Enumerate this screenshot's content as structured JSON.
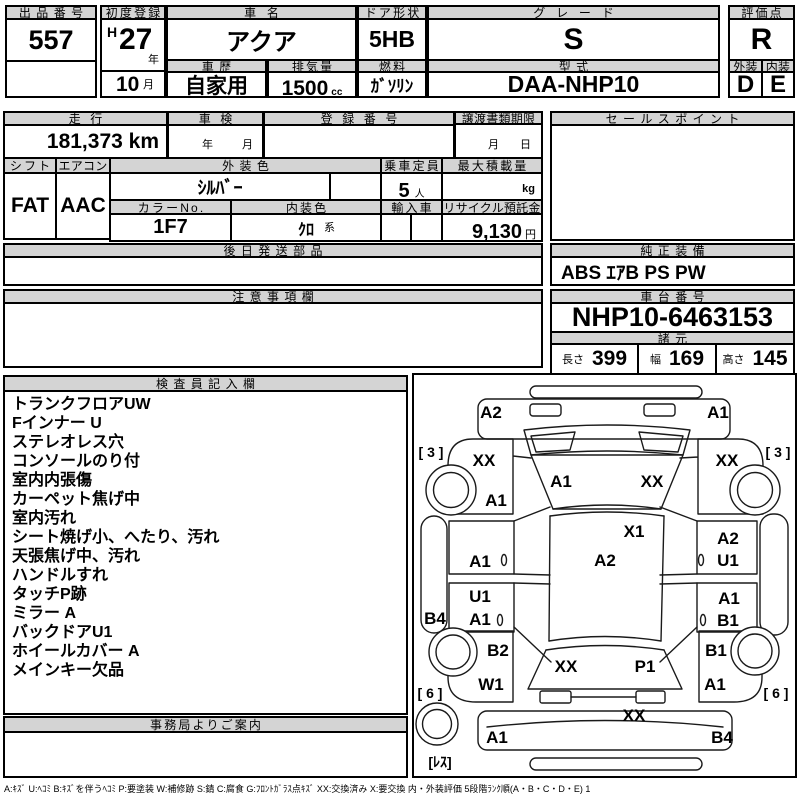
{
  "header": {
    "lot_label": "出品番号",
    "lot_number": "557",
    "first_reg_label": "初度登録",
    "era": "H",
    "reg_year": "27",
    "year_suffix": "年",
    "reg_month": "10",
    "month_suffix": "月",
    "car_name_label": "車名",
    "car_name": "アクア",
    "door_label": "ドア形状",
    "door": "5HB",
    "grade_label": "グレード",
    "grade": "S",
    "score_label": "評価点",
    "score": "R",
    "history_label": "車歴",
    "history": "自家用",
    "displacement_label": "排気量",
    "displacement": "1500",
    "displacement_unit": "cc",
    "fuel_label": "燃料",
    "fuel": "ｶﾞｿﾘﾝ",
    "model_label": "型式",
    "model_code": "DAA-NHP10",
    "exterior_label": "外装",
    "exterior_grade": "D",
    "interior_label": "内装",
    "interior_grade": "E"
  },
  "info": {
    "mileage_label": "走行",
    "mileage": "181,373 km",
    "inspection_label": "車検",
    "inspection_year": "年",
    "inspection_month": "月",
    "registration_label": "登録番号",
    "transfer_label": "譲渡書類期限",
    "transfer_month": "月",
    "transfer_day": "日",
    "shift_label": "シフト",
    "shift": "FAT",
    "aircon_label": "エアコン",
    "aircon": "AAC",
    "ext_color_label": "外装色",
    "ext_color": "ｼﾙﾊﾞｰ",
    "capacity_label": "乗車定員",
    "capacity": "5",
    "capacity_unit": "人",
    "max_load_label": "最大積載量",
    "max_load_unit": "kg",
    "color_no_label": "カラーNo.",
    "color_no": "1F7",
    "int_color_label": "内装色",
    "int_color": "ｸﾛ",
    "int_color_suffix": "系",
    "import_label": "輸入車",
    "recycle_label": "リサイクル預託金",
    "recycle_fee": "9,130",
    "recycle_unit": "円"
  },
  "sales_point": {
    "label": "セールスポイント"
  },
  "later_parts": {
    "label": "後日発送部品"
  },
  "notes": {
    "label": "注意事項欄"
  },
  "equipment": {
    "label": "純正装備",
    "value": "ABS ｴｱB PS PW"
  },
  "chassis": {
    "label": "車台番号",
    "number": "NHP10-6463153"
  },
  "dimensions": {
    "label": "諸元",
    "length_label": "長さ",
    "length": "399",
    "width_label": "幅",
    "width": "169",
    "height_label": "高さ",
    "height": "145"
  },
  "inspector": {
    "label": "検査員記入欄",
    "items": [
      "トランクフロアUW",
      "Fインナー U",
      "ステレオレス穴",
      "コンソールのり付",
      "室内内張傷",
      "カーペット焦げ中",
      "室内汚れ",
      "シート焼げ小、へたり、汚れ",
      "天張焦げ中、汚れ",
      "ハンドルすれ",
      "タッチP跡",
      "ミラー A",
      "バックドアU1",
      "ホイールカバー A",
      "メインキー欠品"
    ]
  },
  "office": {
    "label": "事務局よりご案内"
  },
  "diagram": {
    "marks": [
      "A2",
      "A1",
      "[ 3 ]",
      "XX",
      "XX",
      "[ 3 ]",
      "A1",
      "XX",
      "A1",
      "X1",
      "A2",
      "A2",
      "A1",
      "U1",
      "U1",
      "A1",
      "B4",
      "A1",
      "B1",
      "B2",
      "B1",
      "XX",
      "P1",
      "W1",
      "A1",
      "[ 6 ]",
      "[ 6 ]",
      "XX",
      "A1",
      "B4",
      "[ﾚｽ]"
    ]
  },
  "legend": "A:ｷｽﾞ U:ﾍｺﾐ B:ｷｽﾞを伴うﾍｺﾐ P:要塗装 W:補修跡 S:錆 C:腐食 G:ﾌﾛﾝﾄｶﾞﾗｽ点ｷｽﾞ XX:交換済み X:要交換 内・外装評価 5段階ﾗﾝｸ順(A・B・C・D・E) 1"
}
